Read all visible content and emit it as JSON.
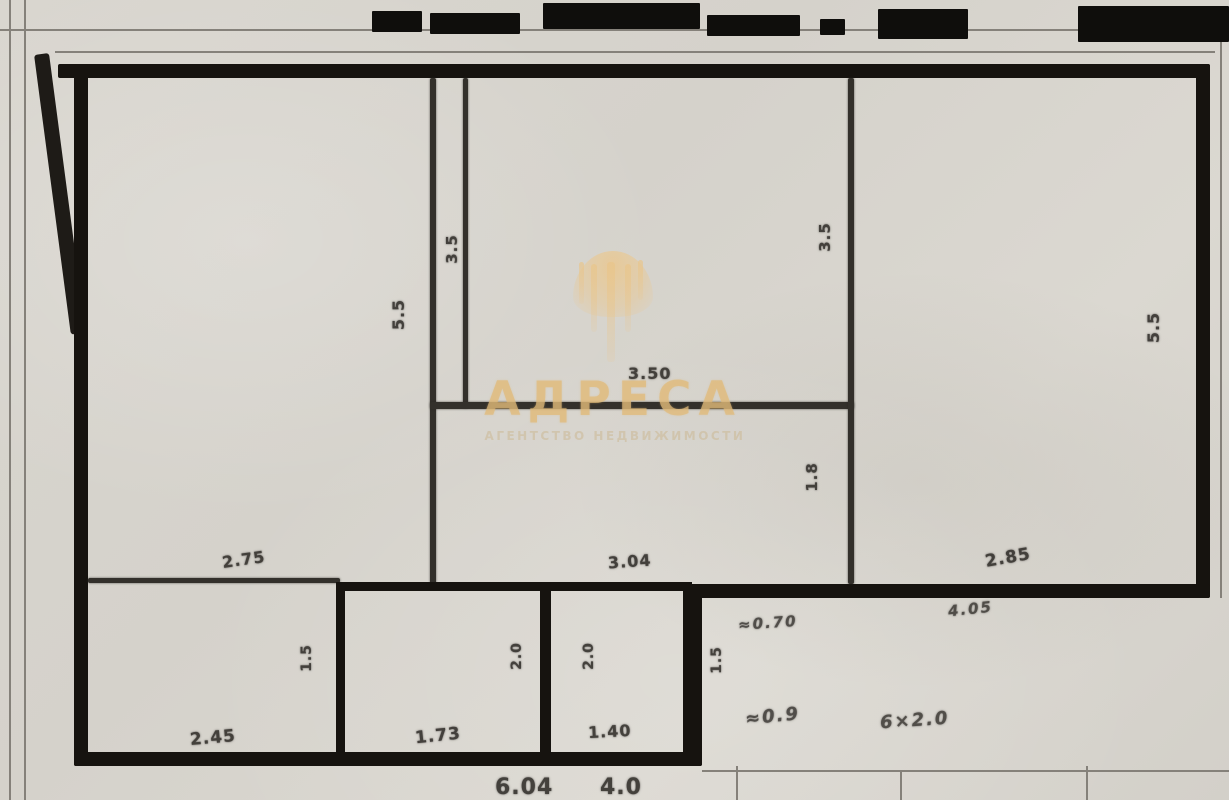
{
  "watermark": {
    "title": "АДРЕСА",
    "subtitle": "АГЕНТСТВО НЕДВИЖИМОСТИ",
    "gold_color": "#e8c88c"
  },
  "floor_plan": {
    "paper_color": "#d9d6cf",
    "wall_color": "#16130f",
    "interior_wall_color": "#33302b",
    "dimensions": [
      {
        "t": "5.5",
        "x": 383,
        "y": 305,
        "r": -90,
        "s": 16
      },
      {
        "t": "3.5",
        "x": 437,
        "y": 240,
        "r": -90,
        "s": 15
      },
      {
        "t": "3.50",
        "x": 628,
        "y": 364,
        "r": 0,
        "s": 16
      },
      {
        "t": "3.5",
        "x": 810,
        "y": 228,
        "r": -90,
        "s": 15
      },
      {
        "t": "1.8",
        "x": 797,
        "y": 468,
        "r": -90,
        "s": 15
      },
      {
        "t": "5.5",
        "x": 1138,
        "y": 318,
        "r": -90,
        "s": 16
      },
      {
        "t": "2.75",
        "x": 222,
        "y": 550,
        "r": -8,
        "s": 16
      },
      {
        "t": "3.04",
        "x": 608,
        "y": 552,
        "r": -4,
        "s": 16
      },
      {
        "t": "2.85",
        "x": 985,
        "y": 548,
        "r": -10,
        "s": 17
      },
      {
        "t": "≈0.70",
        "x": 738,
        "y": 614,
        "r": -4,
        "s": 15,
        "hw": true
      },
      {
        "t": "4.05",
        "x": 948,
        "y": 600,
        "r": -6,
        "s": 15,
        "hw": true
      },
      {
        "t": "1.5",
        "x": 293,
        "y": 650,
        "r": -90,
        "s": 14
      },
      {
        "t": "2.0",
        "x": 503,
        "y": 648,
        "r": -90,
        "s": 14
      },
      {
        "t": "2.0",
        "x": 575,
        "y": 648,
        "r": -90,
        "s": 14
      },
      {
        "t": "1.5",
        "x": 703,
        "y": 652,
        "r": -90,
        "s": 14
      },
      {
        "t": "2.45",
        "x": 190,
        "y": 728,
        "r": -5,
        "s": 17
      },
      {
        "t": "1.73",
        "x": 415,
        "y": 726,
        "r": -6,
        "s": 17
      },
      {
        "t": "1.40",
        "x": 588,
        "y": 722,
        "r": -3,
        "s": 16
      },
      {
        "t": "≈0.9",
        "x": 745,
        "y": 706,
        "r": -6,
        "s": 18,
        "hw": true
      },
      {
        "t": "6×2.0",
        "x": 880,
        "y": 710,
        "r": -4,
        "s": 18,
        "hw": true
      },
      {
        "t": "6.04",
        "x": 495,
        "y": 775,
        "r": 0,
        "s": 22
      },
      {
        "t": "4.0",
        "x": 600,
        "y": 775,
        "r": 0,
        "s": 22
      }
    ]
  }
}
